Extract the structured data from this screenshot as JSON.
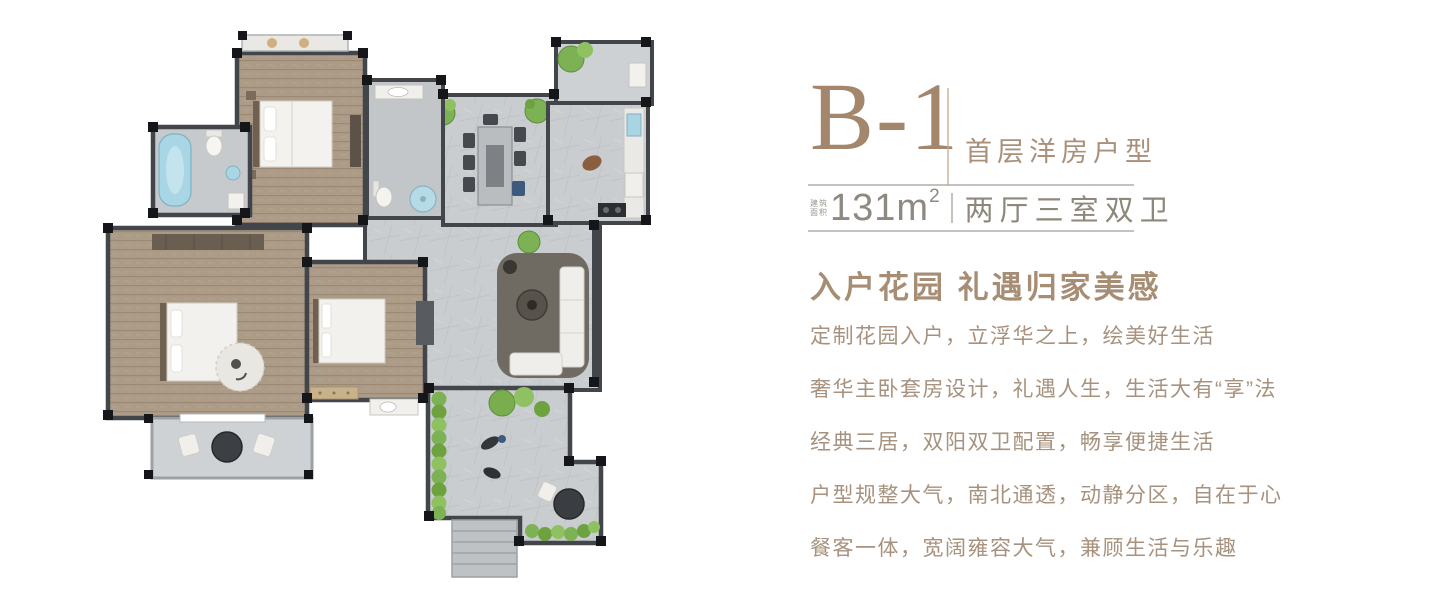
{
  "header": {
    "unit_code": "B-1",
    "unit_type": "首层洋房户型"
  },
  "area_row": {
    "area_label_line1": "建筑",
    "area_label_line2": "面积",
    "area_value": "131m",
    "area_sup": "2",
    "layout": "两厅三室双卫"
  },
  "content": {
    "heading": "入户花园 礼遇归家美感",
    "paragraphs": [
      "定制花园入户，立浮华之上，绘美好生活",
      "奢华主卧套房设计，礼遇人生，生活大有“享”法",
      "经典三居，双阳双卫配置，畅享便捷生活",
      "户型规整大气，南北通透，动静分区，自在于心",
      "餐客一体，宽阔雍容大气，兼顾生活与乐趣"
    ]
  },
  "colors": {
    "accent_bronze": "#a3866b",
    "text_gray": "#8e8981",
    "wall": "#42464a",
    "wood_floor": "#ac9b87",
    "tile_floor": "#c9cdd0",
    "plant_green": "#7db254",
    "tub_blue": "#a9d6e4"
  }
}
